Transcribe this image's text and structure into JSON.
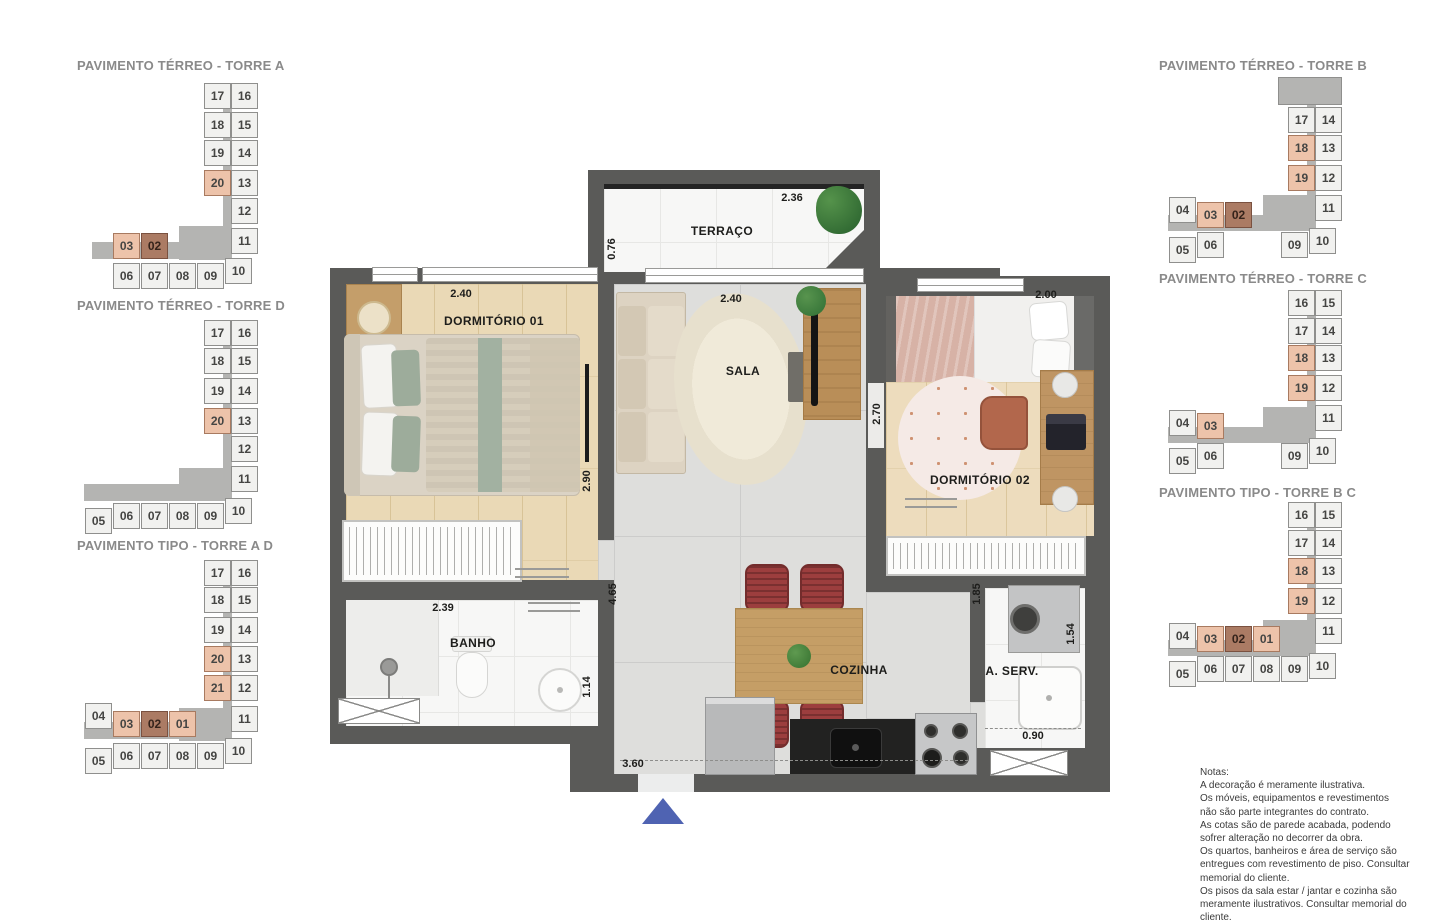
{
  "colors": {
    "wall": "#5a5a58",
    "highlight_light": "#edc3aa",
    "highlight_dark": "#ab7b64",
    "corridor_gray": "#b4b4b2",
    "entry_arrow_blue": "#4f63b2"
  },
  "keyplans": [
    {
      "title": "PAVIMENTO TÉRREO - TORRE A",
      "corridor": [
        {
          "x": 139,
          "y": 14,
          "w": 9,
          "h": 145
        },
        {
          "x": 95,
          "y": 148,
          "w": 52,
          "h": 34
        },
        {
          "x": 8,
          "y": 164,
          "w": 140,
          "h": 17
        }
      ],
      "grayblock": null,
      "cells": [
        {
          "n": "17",
          "x": 120,
          "y": 5
        },
        {
          "n": "16",
          "x": 147,
          "y": 5
        },
        {
          "n": "18",
          "x": 120,
          "y": 34
        },
        {
          "n": "15",
          "x": 147,
          "y": 34
        },
        {
          "n": "19",
          "x": 120,
          "y": 62
        },
        {
          "n": "14",
          "x": 147,
          "y": 62
        },
        {
          "n": "20",
          "x": 120,
          "y": 92,
          "h": 1
        },
        {
          "n": "13",
          "x": 147,
          "y": 92
        },
        {
          "n": "12",
          "x": 147,
          "y": 120
        },
        {
          "n": "11",
          "x": 147,
          "y": 150
        },
        {
          "n": "03",
          "x": 29,
          "y": 155,
          "h": 1
        },
        {
          "n": "02",
          "x": 57,
          "y": 155,
          "h": 2
        },
        {
          "n": "06",
          "x": 29,
          "y": 185
        },
        {
          "n": "07",
          "x": 57,
          "y": 185
        },
        {
          "n": "08",
          "x": 85,
          "y": 185
        },
        {
          "n": "09",
          "x": 113,
          "y": 185
        },
        {
          "n": "10",
          "x": 141,
          "y": 180
        }
      ]
    },
    {
      "title": "PAVIMENTO TÉRREO - TORRE D",
      "corridor": [
        {
          "x": 139,
          "y": 12,
          "w": 9,
          "h": 148
        },
        {
          "x": 95,
          "y": 150,
          "w": 52,
          "h": 33
        },
        {
          "x": 0,
          "y": 166,
          "w": 148,
          "h": 17
        }
      ],
      "grayblock": null,
      "cells": [
        {
          "n": "17",
          "x": 120,
          "y": 2
        },
        {
          "n": "16",
          "x": 147,
          "y": 2
        },
        {
          "n": "18",
          "x": 120,
          "y": 30
        },
        {
          "n": "15",
          "x": 147,
          "y": 30
        },
        {
          "n": "19",
          "x": 120,
          "y": 60
        },
        {
          "n": "14",
          "x": 147,
          "y": 60
        },
        {
          "n": "20",
          "x": 120,
          "y": 90,
          "h": 1
        },
        {
          "n": "13",
          "x": 147,
          "y": 90
        },
        {
          "n": "12",
          "x": 147,
          "y": 118
        },
        {
          "n": "11",
          "x": 147,
          "y": 148
        },
        {
          "n": "05",
          "x": 1,
          "y": 190
        },
        {
          "n": "06",
          "x": 29,
          "y": 185
        },
        {
          "n": "07",
          "x": 57,
          "y": 185
        },
        {
          "n": "08",
          "x": 85,
          "y": 185
        },
        {
          "n": "09",
          "x": 113,
          "y": 185
        },
        {
          "n": "10",
          "x": 141,
          "y": 180
        }
      ]
    },
    {
      "title": "PAVIMENTO TIPO - TORRE A D",
      "corridor": [
        {
          "x": 139,
          "y": 12,
          "w": 9,
          "h": 145
        },
        {
          "x": 95,
          "y": 150,
          "w": 52,
          "h": 33
        },
        {
          "x": 0,
          "y": 164,
          "w": 148,
          "h": 17
        }
      ],
      "grayblock": null,
      "cells": [
        {
          "n": "17",
          "x": 120,
          "y": 2
        },
        {
          "n": "16",
          "x": 147,
          "y": 2
        },
        {
          "n": "18",
          "x": 120,
          "y": 29
        },
        {
          "n": "15",
          "x": 147,
          "y": 29
        },
        {
          "n": "19",
          "x": 120,
          "y": 59
        },
        {
          "n": "14",
          "x": 147,
          "y": 59
        },
        {
          "n": "20",
          "x": 120,
          "y": 88,
          "h": 1
        },
        {
          "n": "13",
          "x": 147,
          "y": 88
        },
        {
          "n": "21",
          "x": 120,
          "y": 117,
          "h": 1
        },
        {
          "n": "12",
          "x": 147,
          "y": 117
        },
        {
          "n": "11",
          "x": 147,
          "y": 148
        },
        {
          "n": "04",
          "x": 1,
          "y": 145
        },
        {
          "n": "03",
          "x": 29,
          "y": 153,
          "h": 1
        },
        {
          "n": "02",
          "x": 57,
          "y": 153,
          "h": 2
        },
        {
          "n": "01",
          "x": 85,
          "y": 153,
          "h": 1
        },
        {
          "n": "05",
          "x": 1,
          "y": 190
        },
        {
          "n": "06",
          "x": 29,
          "y": 185
        },
        {
          "n": "07",
          "x": 57,
          "y": 185
        },
        {
          "n": "08",
          "x": 85,
          "y": 185
        },
        {
          "n": "09",
          "x": 113,
          "y": 185
        },
        {
          "n": "10",
          "x": 141,
          "y": 180
        }
      ]
    },
    {
      "title": "PAVIMENTO TÉRREO - TORRE B",
      "corridor": [
        {
          "x": 139,
          "y": 26,
          "w": 9,
          "h": 100
        },
        {
          "x": 95,
          "y": 120,
          "w": 52,
          "h": 33
        },
        {
          "x": 0,
          "y": 140,
          "w": 148,
          "h": 16
        }
      ],
      "grayblock": {
        "x": 110,
        "y": 2,
        "w": 62,
        "h": 26
      },
      "cells": [
        {
          "n": "17",
          "x": 120,
          "y": 32
        },
        {
          "n": "14",
          "x": 147,
          "y": 32
        },
        {
          "n": "18",
          "x": 120,
          "y": 60,
          "h": 1
        },
        {
          "n": "13",
          "x": 147,
          "y": 60
        },
        {
          "n": "19",
          "x": 120,
          "y": 90,
          "h": 1
        },
        {
          "n": "12",
          "x": 147,
          "y": 90
        },
        {
          "n": "11",
          "x": 147,
          "y": 120
        },
        {
          "n": "04",
          "x": 1,
          "y": 122
        },
        {
          "n": "03",
          "x": 29,
          "y": 127,
          "h": 1
        },
        {
          "n": "02",
          "x": 57,
          "y": 127,
          "h": 2
        },
        {
          "n": "05",
          "x": 1,
          "y": 162
        },
        {
          "n": "06",
          "x": 29,
          "y": 157
        },
        {
          "n": "09",
          "x": 113,
          "y": 157
        },
        {
          "n": "10",
          "x": 141,
          "y": 153
        }
      ]
    },
    {
      "title": "PAVIMENTO TÉRREO - TORRE C",
      "corridor": [
        {
          "x": 139,
          "y": 15,
          "w": 9,
          "h": 110
        },
        {
          "x": 95,
          "y": 122,
          "w": 52,
          "h": 33
        },
        {
          "x": 0,
          "y": 142,
          "w": 148,
          "h": 16
        }
      ],
      "grayblock": null,
      "cells": [
        {
          "n": "16",
          "x": 120,
          "y": 5
        },
        {
          "n": "15",
          "x": 147,
          "y": 5
        },
        {
          "n": "17",
          "x": 120,
          "y": 33
        },
        {
          "n": "14",
          "x": 147,
          "y": 33
        },
        {
          "n": "18",
          "x": 120,
          "y": 60,
          "h": 1
        },
        {
          "n": "13",
          "x": 147,
          "y": 60
        },
        {
          "n": "19",
          "x": 120,
          "y": 90,
          "h": 1
        },
        {
          "n": "12",
          "x": 147,
          "y": 90
        },
        {
          "n": "11",
          "x": 147,
          "y": 120
        },
        {
          "n": "04",
          "x": 1,
          "y": 125
        },
        {
          "n": "03",
          "x": 29,
          "y": 128,
          "h": 1
        },
        {
          "n": "05",
          "x": 1,
          "y": 163
        },
        {
          "n": "06",
          "x": 29,
          "y": 158
        },
        {
          "n": "09",
          "x": 113,
          "y": 158
        },
        {
          "n": "10",
          "x": 141,
          "y": 153
        }
      ]
    },
    {
      "title": "PAVIMENTO TIPO - TORRE B C",
      "corridor": [
        {
          "x": 139,
          "y": 12,
          "w": 9,
          "h": 110
        },
        {
          "x": 95,
          "y": 120,
          "w": 52,
          "h": 33
        },
        {
          "x": 0,
          "y": 140,
          "w": 148,
          "h": 16
        }
      ],
      "grayblock": null,
      "cells": [
        {
          "n": "16",
          "x": 120,
          "y": 2
        },
        {
          "n": "15",
          "x": 147,
          "y": 2
        },
        {
          "n": "17",
          "x": 120,
          "y": 30
        },
        {
          "n": "14",
          "x": 147,
          "y": 30
        },
        {
          "n": "18",
          "x": 120,
          "y": 58,
          "h": 1
        },
        {
          "n": "13",
          "x": 147,
          "y": 58
        },
        {
          "n": "19",
          "x": 120,
          "y": 88,
          "h": 1
        },
        {
          "n": "12",
          "x": 147,
          "y": 88
        },
        {
          "n": "11",
          "x": 147,
          "y": 118
        },
        {
          "n": "04",
          "x": 1,
          "y": 123
        },
        {
          "n": "03",
          "x": 29,
          "y": 126,
          "h": 1
        },
        {
          "n": "02",
          "x": 57,
          "y": 126,
          "h": 2
        },
        {
          "n": "01",
          "x": 85,
          "y": 126,
          "h": 1
        },
        {
          "n": "05",
          "x": 1,
          "y": 161
        },
        {
          "n": "06",
          "x": 29,
          "y": 156
        },
        {
          "n": "07",
          "x": 57,
          "y": 156
        },
        {
          "n": "08",
          "x": 85,
          "y": 156
        },
        {
          "n": "09",
          "x": 113,
          "y": 156
        },
        {
          "n": "10",
          "x": 141,
          "y": 153
        }
      ]
    }
  ],
  "plan": {
    "rooms": {
      "terraco": "TERRAÇO",
      "dorm1": "DORMITÓRIO 01",
      "sala": "SALA",
      "dorm2": "DORMITÓRIO 02",
      "banho": "BANHO",
      "cozinha": "COZINHA",
      "aserv": "A. SERV."
    },
    "dims": {
      "terraco_w": "2.36",
      "terraco_l": "0.76",
      "dorm1_w": "2.40",
      "dorm1_r": "2.90",
      "sala_w": "2.40",
      "dorm2_w": "2.00",
      "dorm2_l": "2.70",
      "banho_w": "2.39",
      "banho_r": "1.14",
      "hall_h": "4.65",
      "entry_w": "3.60",
      "aserv_l": "1.85",
      "aserv_r": "1.54",
      "aserv_b": "0.90"
    }
  },
  "notes": {
    "lines": [
      "Notas:",
      "A decoração é meramente ilustrativa.",
      "Os móveis, equipamentos e revestimentos",
      "não são parte integrantes do contrato.",
      "As cotas são de parede acabada, podendo",
      "sofrer alteração no decorrer da obra.",
      "Os quartos, banheiros e área de serviço são",
      "entregues com revestimento de piso. Consultar",
      "memorial do cliente.",
      "Os pisos da sala estar / jantar e cozinha são",
      "meramente ilustrativos. Consultar memorial do",
      "cliente."
    ]
  }
}
